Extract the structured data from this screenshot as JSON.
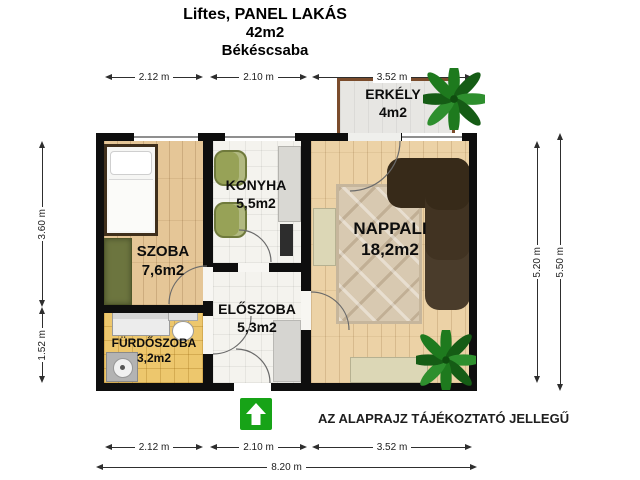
{
  "title": {
    "line1": "Liftes, PANEL LAKÁS",
    "line2": "42m2",
    "line3": "Békéscsaba"
  },
  "rooms": {
    "erkely": {
      "name": "ERKÉLY",
      "area": "4m2"
    },
    "szoba": {
      "name": "SZOBA",
      "area": "7,6m2"
    },
    "konyha": {
      "name": "KONYHA",
      "area": "5,5m2"
    },
    "nappali": {
      "name": "NAPPALI",
      "area": "18,2m2"
    },
    "eloszoba": {
      "name": "ELŐSZOBA",
      "area": "5,3m2"
    },
    "furdoszoba": {
      "name": "FÜRDŐSZOBA",
      "area": "3,2m2"
    }
  },
  "dimensions": {
    "top": [
      "2.12 m",
      "2.10 m",
      "3.52 m"
    ],
    "bottom": [
      "2.12 m",
      "2.10 m",
      "3.52 m"
    ],
    "left": [
      "3.60 m",
      "1.52 m"
    ],
    "right": [
      "5.20 m",
      "5.50 m"
    ],
    "total_width": "8.20 m"
  },
  "note": "AZ ALAPRAJZ TÁJÉKOZTATÓ JELLEGŰ",
  "icons": {
    "entrance_arrow": "up-arrow",
    "plants": [
      "palm-balcony",
      "palm-living-room"
    ]
  },
  "colors": {
    "wall": "#0e0e0e",
    "wood_floor": "#e5c697",
    "living_wood_floor": "#ecd2a6",
    "tile_floor": "#f4f3ee",
    "bath_floor": "#edc76d",
    "balcony_floor": "#e7e6e3",
    "balcony_border": "#7b4c2c",
    "sofa_brown": "#38291a",
    "rug_beige": "#d8c9b1",
    "chair_green": "#97a257",
    "wardrobe_green": "#6c753f",
    "entrance_arrow_green": "#17a317"
  }
}
